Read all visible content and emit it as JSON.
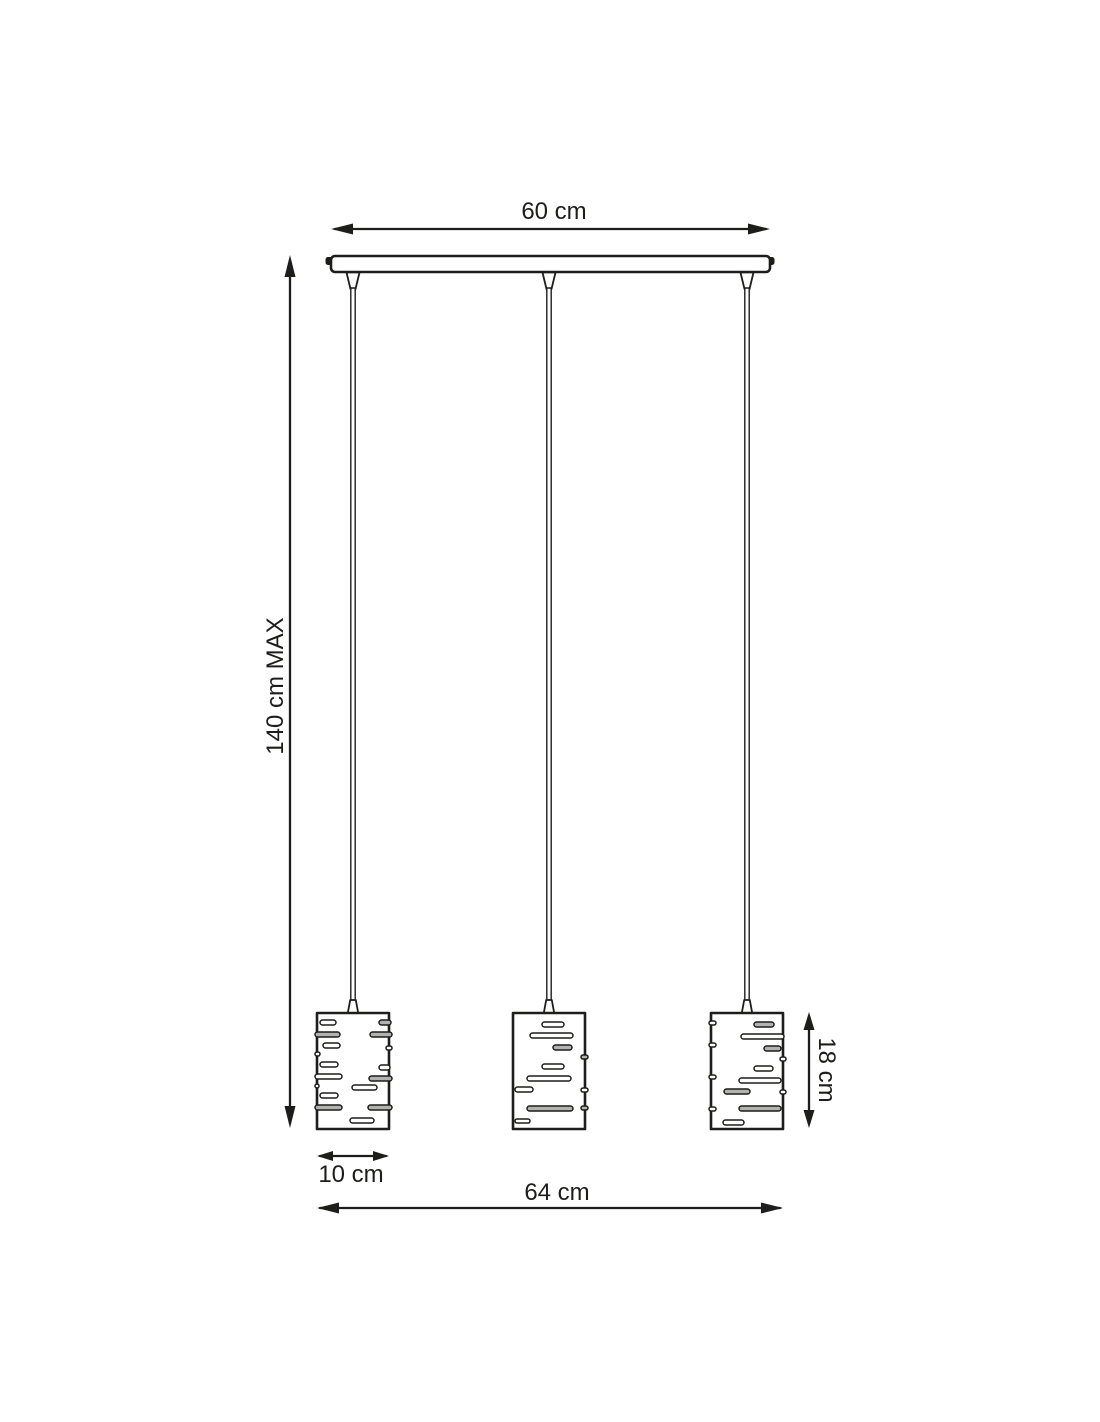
{
  "diagram": {
    "name": "pendant-lamp-dimension-drawing",
    "labels": {
      "canopy_width": "60 cm",
      "max_drop": "140 cm MAX",
      "shade_width": "10 cm",
      "overall_width": "64 cm",
      "shade_height": "18 cm"
    },
    "colors": {
      "line": "#1d1d1b",
      "background": "#ffffff",
      "slot_gray": "#b2b2b2"
    }
  }
}
